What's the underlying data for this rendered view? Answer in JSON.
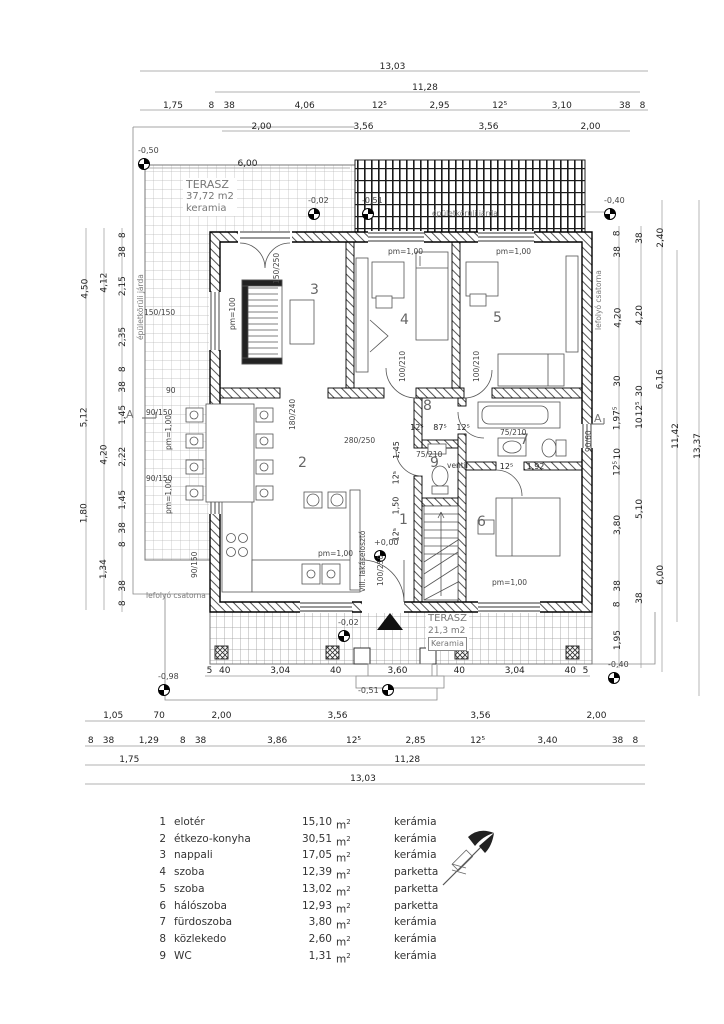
{
  "terrace_top": {
    "name": "TERASZ",
    "area": "37,72 m2",
    "material": "keramia"
  },
  "terrace_bottom": {
    "name": "TERASZ",
    "area": "21,3 m2",
    "material": "Keramia"
  },
  "rooms": {
    "r1": "1",
    "r2": "2",
    "r3": "3",
    "r4": "4",
    "r5": "5",
    "r6": "6",
    "r7": "7",
    "r8": "8",
    "r9": "9"
  },
  "levels": {
    "walkway_tl": "-0,50",
    "terrace_top_a": "-0,02",
    "terrace_top_b": "-0,51",
    "walkway_tr": "-0,40",
    "floor": "+0,00",
    "terrace_bot_a": "-0,02",
    "terrace_bot_b": "-0,51",
    "walkway_bl": "-0,98",
    "walkway_br": "-0,40"
  },
  "texts": {
    "jarda": "épületkörüli járda",
    "jarda2": "épületkörüli járda",
    "lefolyo": "lefolyó csatorna",
    "lefolyo2": "lefolyó csatorna",
    "villa": "vill. lakáselosztó",
    "ventil": "ventil",
    "section": "A"
  },
  "ann": {
    "pm": "pm=1,00",
    "pm100": "pm=100",
    "d150_250": "150/250",
    "d180_240": "180/240",
    "d280_250": "280/250",
    "d100_210": "100/210",
    "d100_250": "100/250",
    "d75_210": "75/210",
    "w90_60": "90/60",
    "w90_150": "90/150",
    "w150_150": "150/150",
    "n90": "90"
  },
  "dims": {
    "t1": [
      "13,03"
    ],
    "t2": [
      "11,28"
    ],
    "t3": [
      {
        "t": "1,75",
        "w": 1.75
      },
      {
        "t": "8",
        "w": 0.2
      },
      {
        "t": "38",
        "w": 0.5
      },
      {
        "t": "4,06",
        "w": 4.06
      },
      {
        "t": "12⁵",
        "w": 0.3
      },
      {
        "t": "2,95",
        "w": 2.95
      },
      {
        "t": "12⁵",
        "w": 0.3
      },
      {
        "t": "3,10",
        "w": 3.1
      },
      {
        "t": "38",
        "w": 0.5
      },
      {
        "t": "8",
        "w": 0.2
      }
    ],
    "t4": [
      {
        "t": "2,00",
        "w": 2
      },
      {
        "t": "3,56",
        "w": 3.56
      },
      {
        "t": "3,56",
        "w": 3.56
      },
      {
        "t": "2,00",
        "w": 2
      }
    ],
    "t5": [
      "6,00"
    ],
    "b1": [
      {
        "t": "5",
        "w": 0.14
      },
      {
        "t": "40",
        "w": 0.45
      },
      {
        "t": "3,04",
        "w": 3.04
      },
      {
        "t": "40",
        "w": 0.45
      },
      {
        "t": "3,60",
        "w": 3.6
      },
      {
        "t": "40",
        "w": 0.45
      },
      {
        "t": "3,04",
        "w": 3.04
      },
      {
        "t": "40",
        "w": 0.45
      },
      {
        "t": "5",
        "w": 0.14
      }
    ],
    "b2": [
      {
        "t": "1,05",
        "w": 1.05
      },
      {
        "t": "70",
        "w": 0.7
      },
      {
        "t": "2,00",
        "w": 2
      },
      {
        "t": "3,56",
        "w": 3.56
      },
      {
        "t": "3,56",
        "w": 3.56
      },
      {
        "t": "2,00",
        "w": 2
      }
    ],
    "b3": [
      {
        "t": "8",
        "w": 0.2
      },
      {
        "t": "38",
        "w": 0.45
      },
      {
        "t": "1,29",
        "w": 1.29
      },
      {
        "t": "8",
        "w": 0.2
      },
      {
        "t": "38",
        "w": 0.45
      },
      {
        "t": "3,86",
        "w": 3.86
      },
      {
        "t": "12⁵",
        "w": 0.3
      },
      {
        "t": "2,85",
        "w": 2.85
      },
      {
        "t": "12⁵",
        "w": 0.3
      },
      {
        "t": "3,40",
        "w": 3.4
      },
      {
        "t": "38",
        "w": 0.45
      },
      {
        "t": "8",
        "w": 0.2
      }
    ],
    "b4": [
      {
        "t": "1,75",
        "w": 1.75
      },
      {
        "t": "11,28",
        "w": 11.28
      }
    ],
    "b5": [
      "13,03"
    ],
    "l_inner": [
      {
        "t": "8",
        "w": 0.25
      },
      {
        "t": "38",
        "w": 0.55
      },
      {
        "t": "2,15",
        "w": 2.15
      },
      {
        "t": "2,35",
        "w": 2.35
      },
      {
        "t": "8",
        "w": 0.25
      },
      {
        "t": "38",
        "w": 0.55
      },
      {
        "t": "1,45",
        "w": 1.45
      },
      {
        "t": "2,22",
        "w": 2.22
      },
      {
        "t": "1,45",
        "w": 1.45
      },
      {
        "t": "38",
        "w": 0.55
      },
      {
        "t": "8",
        "w": 0.25
      },
      {
        "t": "",
        "w": 1.34
      },
      {
        "t": "38",
        "w": 0.55
      },
      {
        "t": "8",
        "w": 0.25
      }
    ],
    "l_mid": [
      {
        "t": "4,12",
        "w": 4.12
      },
      {
        "t": "",
        "w": 2.55
      },
      {
        "t": "4,20",
        "w": 4.2
      },
      {
        "t": "",
        "w": 1.6
      },
      {
        "t": "1,34",
        "w": 1.34
      },
      {
        "t": "",
        "w": 0.8
      }
    ],
    "l_out": [
      {
        "t": "4,50",
        "w": 4.5
      },
      {
        "t": "5,12",
        "w": 5.12
      },
      {
        "t": "1,80",
        "w": 1.8
      },
      {
        "t": "",
        "w": 2.8
      }
    ],
    "r1c": [
      {
        "t": "8",
        "w": 0.2
      },
      {
        "t": "38",
        "w": 0.5
      },
      {
        "t": "4,20",
        "w": 4.2
      },
      {
        "t": "30",
        "w": 0.35
      },
      {
        "t": "1,97⁵",
        "w": 1.975
      },
      {
        "t": "10",
        "w": 0.15
      },
      {
        "t": "12⁵",
        "w": 0.2
      },
      {
        "t": "3,80",
        "w": 3.8
      },
      {
        "t": "38",
        "w": 0.5
      },
      {
        "t": "8",
        "w": 0.2
      },
      {
        "t": "1,95",
        "w": 1.95
      }
    ],
    "r2c": [
      {
        "t": "38",
        "w": 0.5
      },
      {
        "t": "4,20",
        "w": 4.2
      },
      {
        "t": "30",
        "w": 0.35
      },
      {
        "t": "12⁵",
        "w": 0.2
      },
      {
        "t": "10",
        "w": 0.15
      },
      {
        "t": "5,10",
        "w": 5.1
      },
      {
        "t": "38",
        "w": 0.5
      },
      {
        "t": "",
        "w": 2.0
      }
    ],
    "r3c": [
      {
        "t": "2,40",
        "w": 2.4
      },
      {
        "t": "6,16",
        "w": 6.16
      },
      {
        "t": "6,00",
        "w": 6.0
      }
    ],
    "r4c": [
      "11,42"
    ],
    "r5c": [
      "13,37"
    ],
    "i1": [
      {
        "t": "12⁵",
        "w": 0.25
      },
      {
        "t": "87⁵",
        "w": 0.875
      },
      {
        "t": "12⁵",
        "w": 0.25
      }
    ],
    "i2": [
      {
        "t": "12⁵",
        "w": 0.5
      },
      {
        "t": "1,92",
        "w": 1.9
      }
    ],
    "i3": [
      {
        "t": "1,45",
        "w": 1.45
      },
      {
        "t": "12⁵",
        "w": 0.3
      },
      {
        "t": "1,50",
        "w": 1.5
      },
      {
        "t": "12⁵",
        "w": 0.3
      }
    ]
  },
  "legend": {
    "unit": "m",
    "sup": "2",
    "rows": [
      {
        "num": "1",
        "name": "elotér",
        "area": "15,10",
        "mat": "kerámia"
      },
      {
        "num": "2",
        "name": "étkezo-konyha",
        "area": "30,51",
        "mat": "kerámia"
      },
      {
        "num": "3",
        "name": "nappali",
        "area": "17,05",
        "mat": "kerámia"
      },
      {
        "num": "4",
        "name": "szoba",
        "area": "12,39",
        "mat": "parketta"
      },
      {
        "num": "5",
        "name": "szoba",
        "area": "13,02",
        "mat": "parketta"
      },
      {
        "num": "6",
        "name": "hálószoba",
        "area": "12,93",
        "mat": "parketta"
      },
      {
        "num": "7",
        "name": "fürdoszoba",
        "area": "3,80",
        "mat": "kerámia"
      },
      {
        "num": "8",
        "name": "közlekedo",
        "area": "2,60",
        "mat": "kerámia"
      },
      {
        "num": "9",
        "name": "WC",
        "area": "1,31",
        "mat": "kerámia"
      }
    ]
  }
}
